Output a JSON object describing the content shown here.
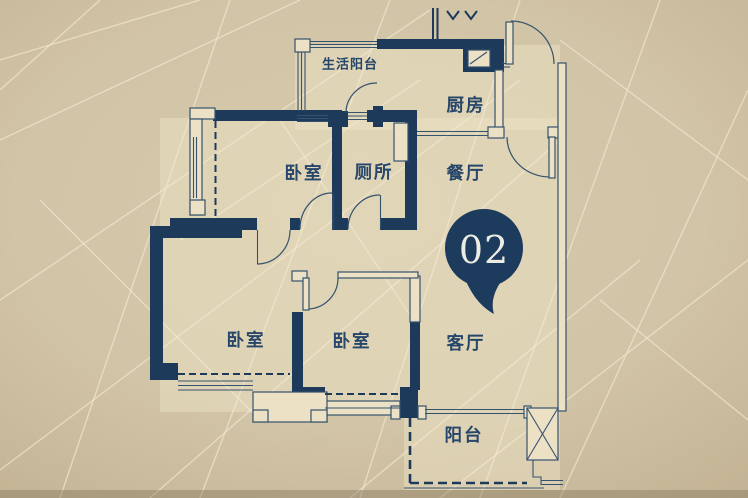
{
  "marker": {
    "number": "02"
  },
  "labels": {
    "service_balcony": "生活阳台",
    "kitchen": "厨房",
    "bedroom_top": "卧室",
    "toilet": "厕所",
    "dining": "餐厅",
    "bedroom_left": "卧室",
    "bedroom_middle": "卧室",
    "living_room": "客厅",
    "balcony": "阳台"
  },
  "colors": {
    "wall": "#1e3a5a",
    "line": "#35536f",
    "text": "#26466a",
    "marker": "#1c3b5d",
    "markerText": "#edece4",
    "paper": "#ece1c4",
    "pattern": "#f2e9d1"
  }
}
